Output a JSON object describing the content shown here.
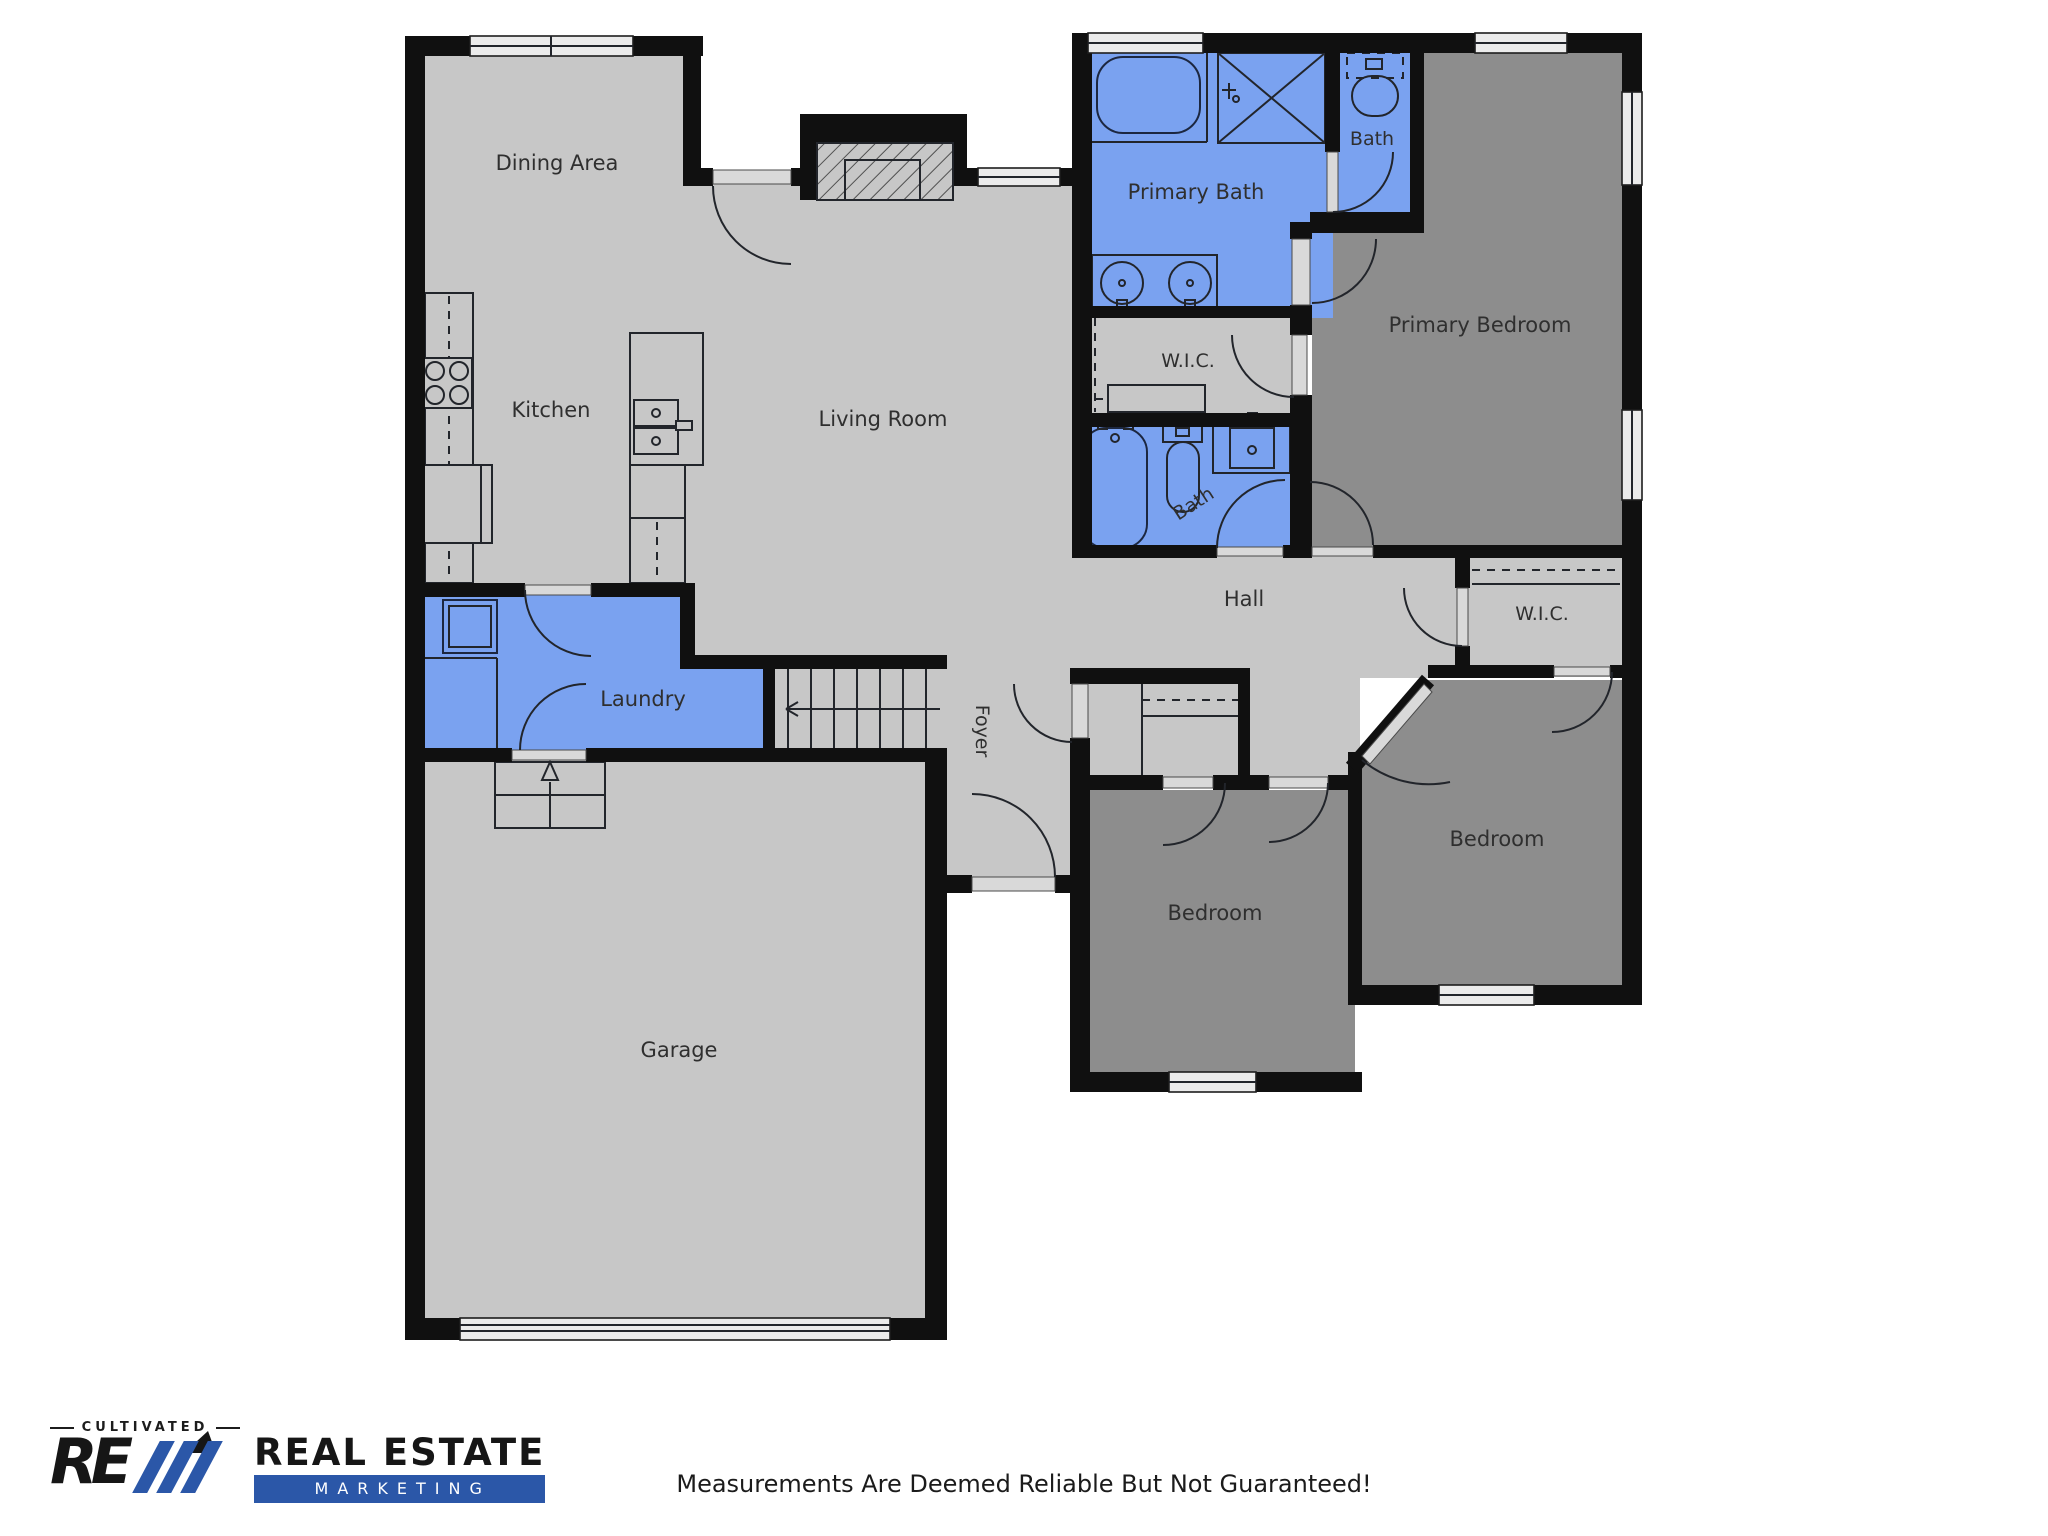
{
  "floorplan": {
    "colors": {
      "wall": "#101010",
      "floor_light": "#c7c7c7",
      "floor_dark": "#8d8d8d",
      "floor_wet": "#7aa2f0",
      "window_fill": "#ebebeb",
      "door_sill": "#d9d9d9",
      "label_text": "#2f2f2f"
    },
    "rooms": {
      "dining": {
        "label": "Dining Area"
      },
      "kitchen": {
        "label": "Kitchen"
      },
      "living": {
        "label": "Living Room"
      },
      "primary_bath": {
        "label": "Primary Bath"
      },
      "bath_upper": {
        "label": "Bath"
      },
      "bath_hall": {
        "label": "Bath"
      },
      "primary_bedroom": {
        "label": "Primary Bedroom"
      },
      "wic_primary": {
        "label": "W.I.C."
      },
      "wic_bedroom": {
        "label": "W.I.C."
      },
      "hall": {
        "label": "Hall"
      },
      "laundry": {
        "label": "Laundry"
      },
      "foyer": {
        "label": "Foyer"
      },
      "garage": {
        "label": "Garage"
      },
      "bedroom_middle": {
        "label": "Bedroom"
      },
      "bedroom_right": {
        "label": "Bedroom"
      }
    }
  },
  "logo": {
    "tagline": "CULTIVATED",
    "monogram": "RE",
    "title": "REAL ESTATE",
    "subtitle": "MARKETING",
    "accent_color": "#2b57a8"
  },
  "footer": {
    "disclaimer": "Measurements Are Deemed Reliable But Not Guaranteed!"
  }
}
